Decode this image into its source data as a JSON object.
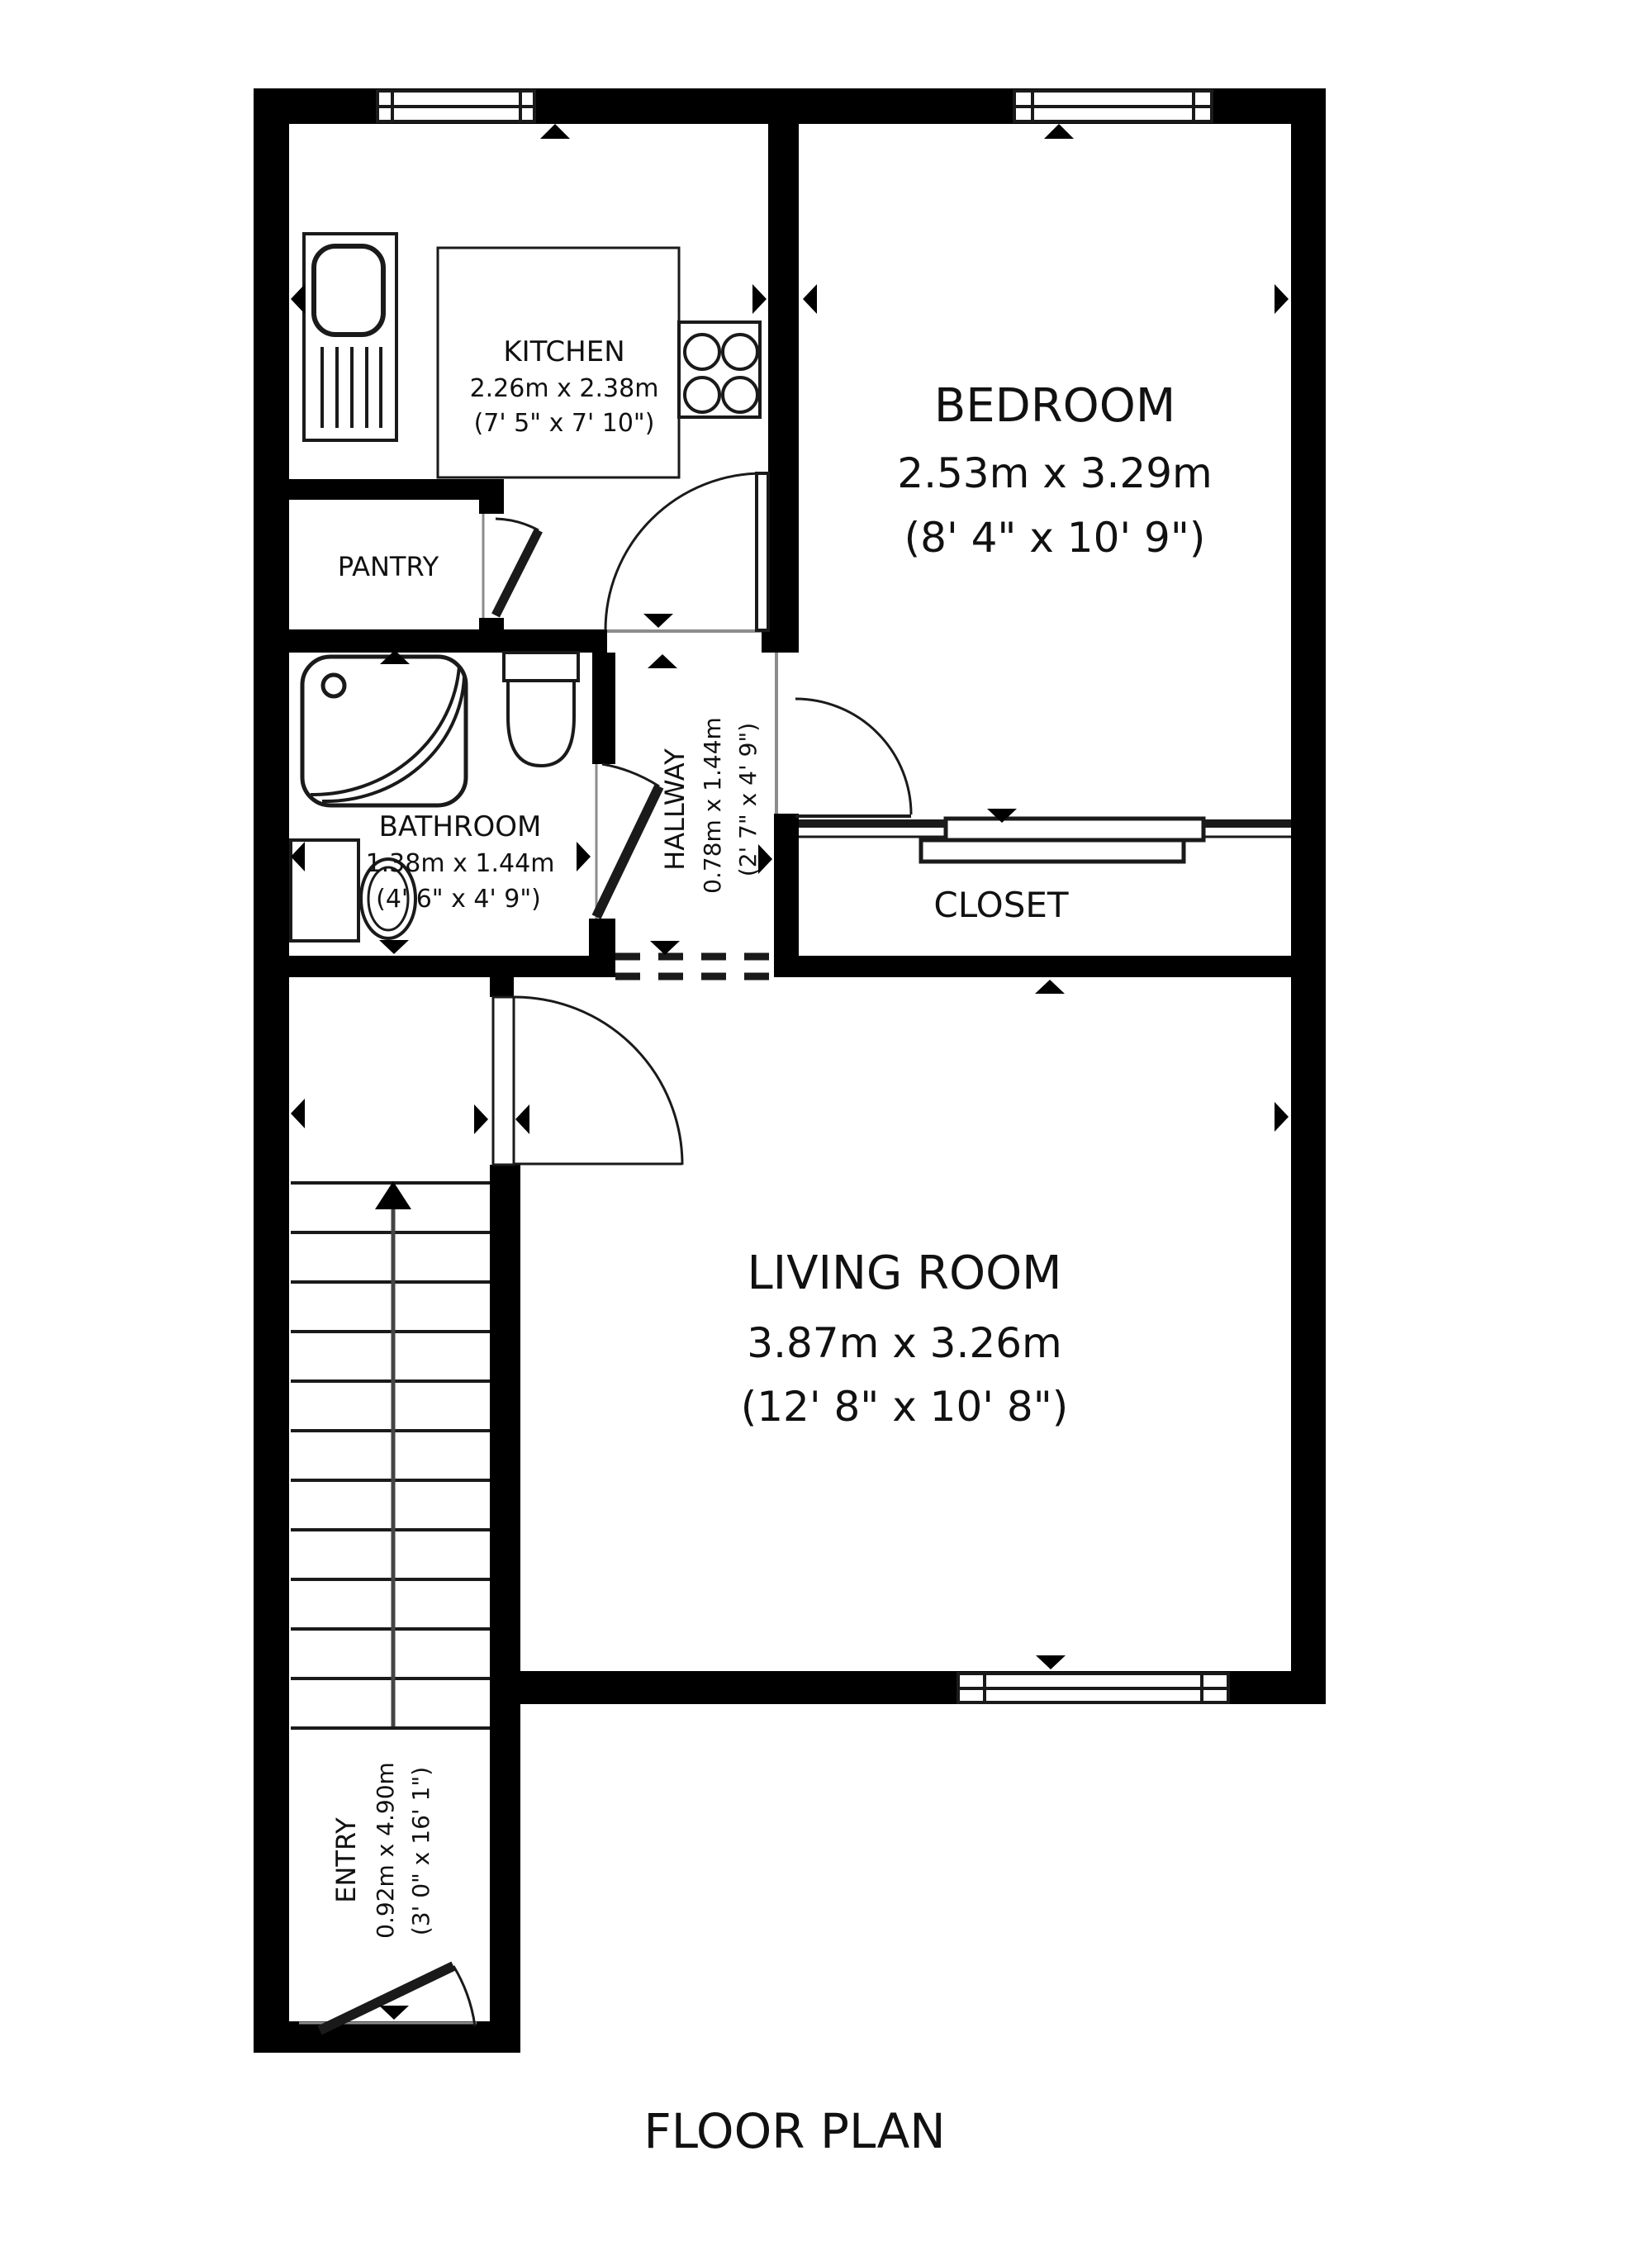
{
  "title": "FLOOR PLAN",
  "colors": {
    "wall": "#000000",
    "background": "#ffffff",
    "line": "#1a1a1a",
    "sill": "#8c8c8c"
  },
  "rooms": {
    "kitchen": {
      "name": "KITCHEN",
      "metric": "2.26m x 2.38m",
      "imperial": "(7' 5\" x 7' 10\")"
    },
    "bedroom": {
      "name": "BEDROOM",
      "metric": "2.53m x 3.29m",
      "imperial": "(8' 4\" x 10' 9\")"
    },
    "pantry": {
      "name": "PANTRY"
    },
    "bathroom": {
      "name": "BATHROOM",
      "metric": "1.38m x 1.44m",
      "imperial": "(4' 6\" x 4' 9\")"
    },
    "hallway": {
      "name": "HALLWAY",
      "metric": "0.78m x 1.44m",
      "imperial": "(2' 7\" x 4' 9\")"
    },
    "closet": {
      "name": "CLOSET"
    },
    "living_room": {
      "name": "LIVING ROOM",
      "metric": "3.87m x 3.26m",
      "imperial": "(12' 8\" x 10' 8\")"
    },
    "entry": {
      "name": "ENTRY",
      "metric": "0.92m x 4.90m",
      "imperial": "(3' 0\" x 16' 1\")"
    }
  }
}
